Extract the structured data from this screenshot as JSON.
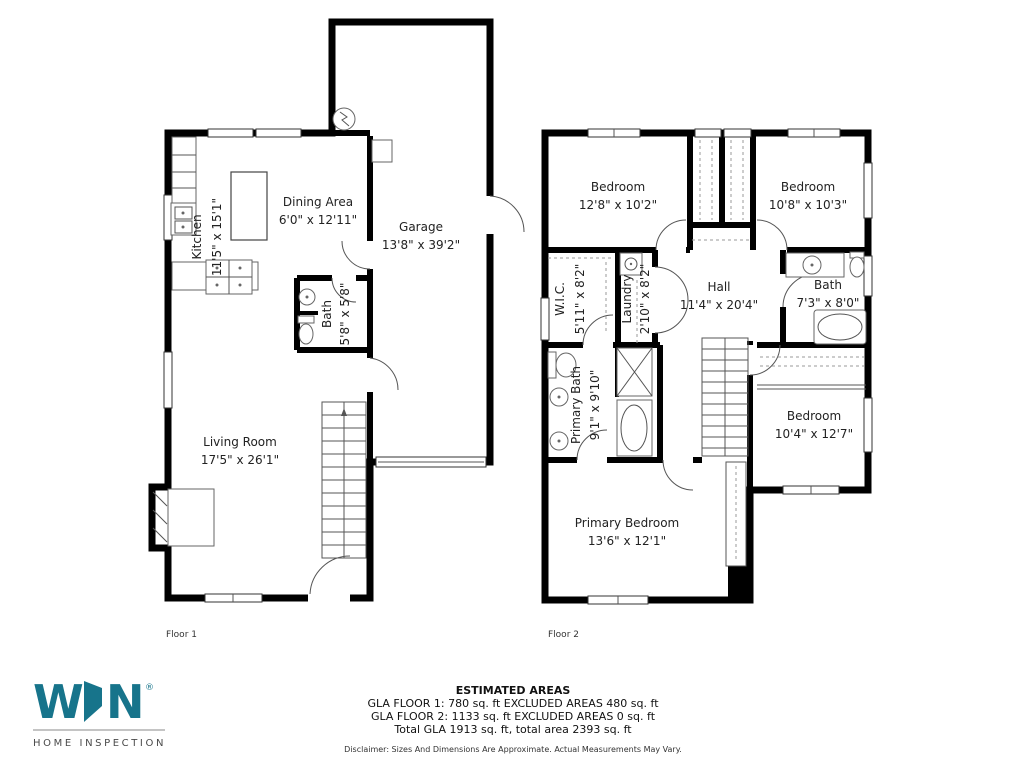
{
  "floor1": {
    "label": "Floor 1",
    "rooms": {
      "kitchen": {
        "name": "Kitchen",
        "dims": "11'5\" x 15'1\""
      },
      "dining": {
        "name": "Dining Area",
        "dims": "6'0\" x 12'11\""
      },
      "garage": {
        "name": "Garage",
        "dims": "13'8\" x 39'2\""
      },
      "bath": {
        "name": "Bath",
        "dims": "5'8\" x 5'8\""
      },
      "living": {
        "name": "Living Room",
        "dims": "17'5\" x 26'1\""
      }
    }
  },
  "floor2": {
    "label": "Floor 2",
    "rooms": {
      "bedroom_left": {
        "name": "Bedroom",
        "dims": "12'8\" x 10'2\""
      },
      "bedroom_right": {
        "name": "Bedroom",
        "dims": "10'8\" x 10'3\""
      },
      "wic": {
        "name": "W.I.C.",
        "dims": "5'11\" x 8'2\""
      },
      "laundry": {
        "name": "Laundry",
        "dims": "2'10\" x 8'2\""
      },
      "hall": {
        "name": "Hall",
        "dims": "11'4\" x 20'4\""
      },
      "bath": {
        "name": "Bath",
        "dims": "7'3\" x 8'0\""
      },
      "primary_bath": {
        "name": "Primary Bath",
        "dims": "9'1\" x 9'10\""
      },
      "bedroom_mid": {
        "name": "Bedroom",
        "dims": "10'4\" x 12'7\""
      },
      "primary_bedroom": {
        "name": "Primary Bedroom",
        "dims": "13'6\" x 12'1\""
      }
    }
  },
  "footer": {
    "logo": {
      "letter_w": "W",
      "letter_n": "N",
      "registered": "®",
      "tagline": "HOME INSPECTION",
      "brand_color": "#17748b"
    },
    "areas": {
      "title": "ESTIMATED AREAS",
      "line1": "GLA FLOOR 1: 780 sq. ft EXCLUDED AREAS 480 sq. ft",
      "line2": "GLA FLOOR 2: 1133 sq. ft EXCLUDED AREAS 0 sq. ft",
      "line3": "Total GLA 1913 sq. ft, total area 2393 sq. ft",
      "disclaimer": "Disclaimer: Sizes And Dimensions Are Approximate. Actual Measurements May Vary."
    }
  }
}
